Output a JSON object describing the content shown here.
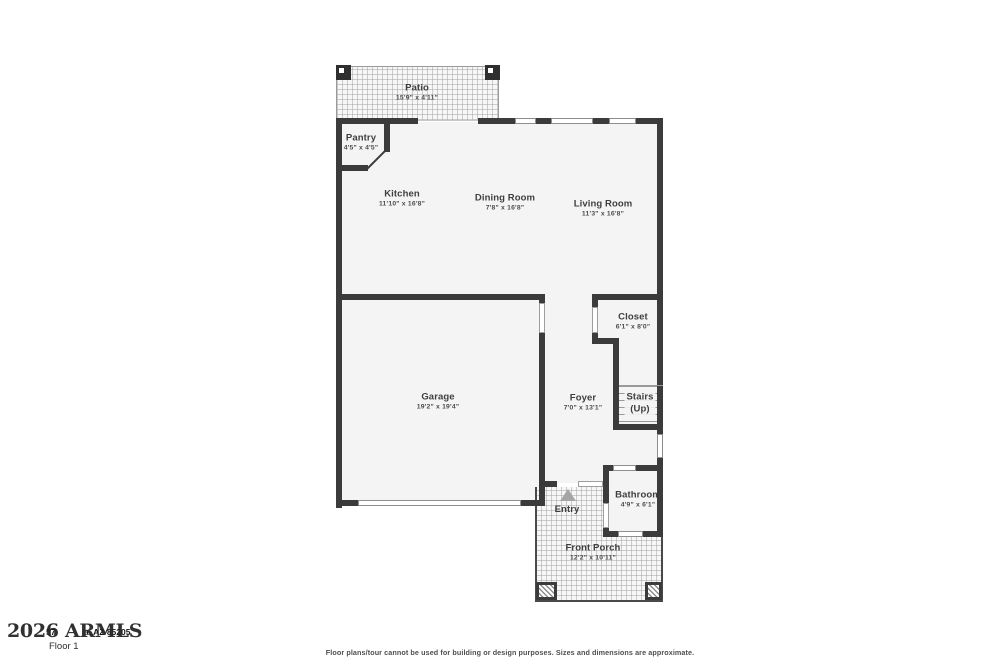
{
  "plan": {
    "rooms": [
      {
        "name": "Patio",
        "dims": "15'9\" x 4'11\""
      },
      {
        "name": "Pantry",
        "dims": "4'5\" x 4'5\""
      },
      {
        "name": "Kitchen",
        "dims": "11'10\" x 16'8\""
      },
      {
        "name": "Dining Room",
        "dims": "7'8\" x 16'8\""
      },
      {
        "name": "Living Room",
        "dims": "11'3\" x 16'8\""
      },
      {
        "name": "Closet",
        "dims": "6'1\" x 8'0\""
      },
      {
        "name": "Garage",
        "dims": "19'2\" x 19'4\""
      },
      {
        "name": "Foyer",
        "dims": "7'0\" x 13'1\""
      },
      {
        "name": "Stairs",
        "sub": "(Up)"
      },
      {
        "name": "Bathroom",
        "dims": "4'9\" x 6'1\""
      },
      {
        "name": "Entry"
      },
      {
        "name": "Front Porch",
        "dims": "12'2\" x 10'11\""
      }
    ]
  },
  "footer": {
    "watermark": "2026 ARMLS",
    "address_fragment_number": "57",
    "address_fragment_city": "a, AZ 85205",
    "floor_label": "Floor 1",
    "disclaimer": "Floor plans/tour cannot be used for building or design purposes. Sizes and dimensions are approximate."
  },
  "colors": {
    "wall": "#3b3b3b",
    "room_fill": "#f4f4f4",
    "texture_line": "#a0a0a0",
    "label_text": "#3e3e3e"
  }
}
